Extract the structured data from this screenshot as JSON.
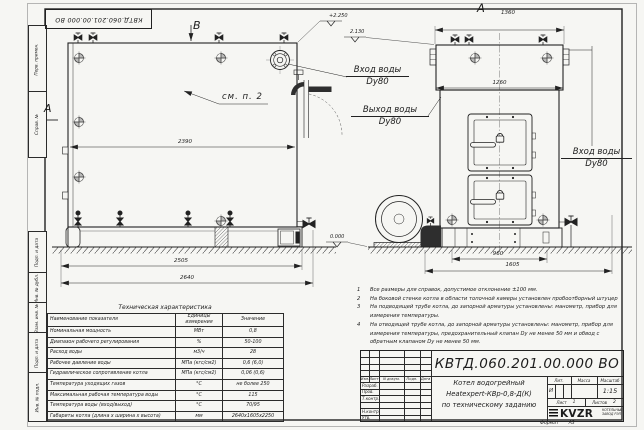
{
  "sheet": {
    "doc_number": "КВТД.060.201.00.000 ВО",
    "format_label": "Формат",
    "format_value": "А3"
  },
  "margin": {
    "items": [
      "Перв. примен.",
      "Справ. №",
      "Подп. и дата",
      "Инв. № дубл.",
      "Взам. инв. №",
      "Подп. и дата",
      "Инв. № подл."
    ]
  },
  "views": {
    "view_b": "В",
    "view_a_side": "А",
    "view_a_front": "А",
    "see_note": "см. п. 2",
    "elev_top": "+2.250",
    "elev_mid": "2.130",
    "elev_zero": "0.000",
    "dims": {
      "d2390": "2390",
      "d2505": "2505",
      "d2640": "2640",
      "d1360": "1360",
      "d1260": "1260",
      "d960": "960",
      "d1605": "1605"
    },
    "ports": {
      "inlet_top": {
        "line1": "Вход воды",
        "line2": "Dy80"
      },
      "outlet": {
        "line1": "Выход воды",
        "line2": "Dy80"
      },
      "inlet_right": {
        "line1": "Вход воды",
        "line2": "Dy80"
      }
    }
  },
  "notes": {
    "items": [
      {
        "num": "1",
        "text": "Все размеры для справок, допустимое отклонение ±100 мм."
      },
      {
        "num": "2",
        "text": "На боковой стенке котла в области топочной камеры установлен пробоотборный штуцер"
      },
      {
        "num": "3",
        "text": "На подводящей трубе котла, до запорной арматуры установлены: манометр, прибор для измерения температуры."
      },
      {
        "num": "4",
        "text": "На отводящей трубе котла, до запорной арматуры установлены: манометр, прибор для измерения температуры, предохранительный клапан Dу не менее 50 мм и обвод с обратным клапаном Dу не менее 50 мм."
      }
    ]
  },
  "spec_table": {
    "title": "Техническая характеристика",
    "headers": [
      "Наименование показателя",
      "Единицы измерения",
      "Значение"
    ],
    "rows": [
      {
        "name": "Номинальная мощность",
        "unit": "МВт",
        "value": "0,8"
      },
      {
        "name": "Диапазон рабочего регулирования",
        "unit": "%",
        "value": "50-100"
      },
      {
        "name": "Расход воды",
        "unit": "м3/ч",
        "value": "28"
      },
      {
        "name": "Рабочее давление воды",
        "unit": "МПа (кгс/см2)",
        "value": "0,6 (6,0)"
      },
      {
        "name": "Гидравлическое сопротивление котла",
        "unit": "МПа (кгс/см2)",
        "value": "0,06 (0,6)"
      },
      {
        "name": "Температура уходящих газов",
        "unit": "°С",
        "value": "не более 250"
      },
      {
        "name": "Максимальная рабочая температура воды",
        "unit": "°С",
        "value": "115"
      },
      {
        "name": "Температура воды (вход/выход)",
        "unit": "°С",
        "value": "70/95"
      },
      {
        "name": "Габариты котла (длина х ширина х высота)",
        "unit": "мм",
        "value": "2640х1605х2250"
      }
    ]
  },
  "title_block": {
    "doc_number": "КВТД.060.201.00.000 ВО",
    "description_lines": [
      "Котел водогрейный",
      "Heatexpert-КВр-0,8-Д(К)",
      "по техническому заданию"
    ],
    "columns": [
      "Изм.",
      "Лист",
      "N докум.",
      "Подп.",
      "Дата"
    ],
    "sign_rows": [
      "Разраб.",
      "Пров.",
      "Т.контр.",
      "",
      "Н.контр.",
      "Утв."
    ],
    "lit_label": "Лит.",
    "lit_value": "И",
    "mass_label": "Масса",
    "scale_label": "Масштаб",
    "scale_value": "1:15",
    "sheet_label": "Лист",
    "sheet_value": "1",
    "sheets_label": "Листов",
    "sheets_value": "2",
    "logo_text": "KVZR",
    "company_line1": "КОТЕЛЬНЫЙ",
    "company_line2": "ЗАВОД РЭП"
  }
}
